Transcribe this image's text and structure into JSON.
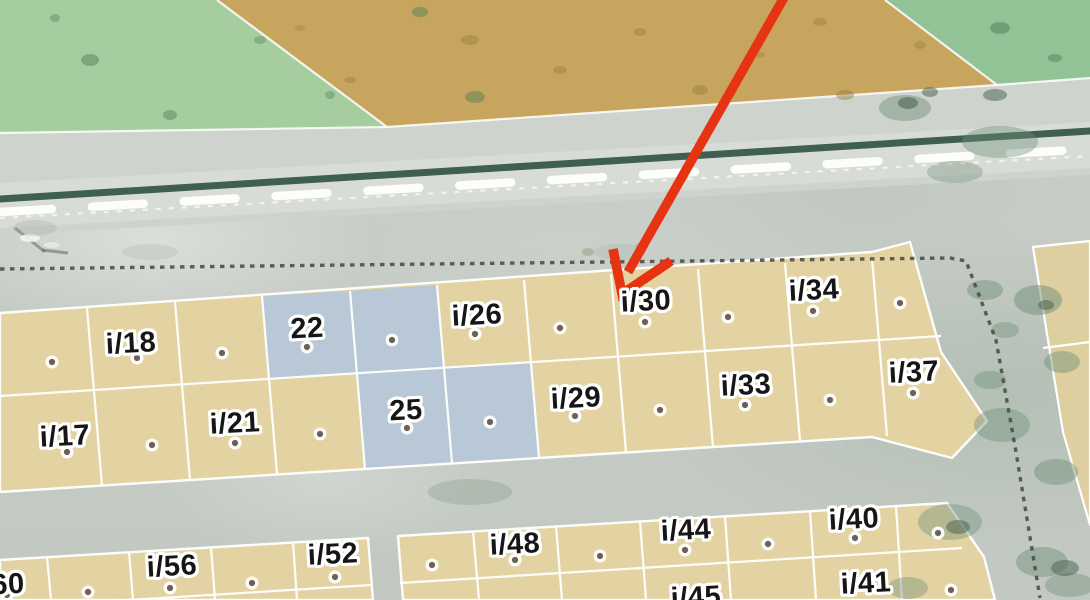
{
  "map": {
    "viewport": {
      "width": 1090,
      "height": 600
    },
    "colors": {
      "background": "#c6ccc6",
      "field_green_left": "#a5cd9f",
      "field_tan": "#c7a55e",
      "field_green_right": "#92c397",
      "road_band": "#ced3cd",
      "road_stripe": "#dde1da",
      "treeline": "#2f5244",
      "lane_dash": "#ffffff",
      "plot_fill": "#e4d3a2",
      "plot_blue": "#b8c8d6",
      "plot_line": "#ffffff",
      "boundary_dots": "#4b4b48",
      "arrow": "#e63312",
      "label_text": "#161616",
      "label_halo": "#ffffff",
      "marker_ring": "#ffffff",
      "marker_core": "#6a6258"
    },
    "fields": [
      {
        "name": "field-green-left",
        "points": "0,0 217,0 387,127 0,133",
        "fill": "#a5cd9f"
      },
      {
        "name": "field-tan",
        "points": "217,0 885,0 997,85 387,127",
        "fill": "#c7a55e"
      },
      {
        "name": "field-green-right",
        "points": "885,0 1090,0 1090,78 997,85",
        "fill": "#92c397"
      }
    ],
    "field_lines": [
      "217,0 387,127",
      "885,0 997,85",
      "0,133 387,127 997,85 1090,78"
    ],
    "road": {
      "band": "0,133 387,127 997,85 1090,78 1090,175 0,235",
      "stripe": "0,183 1090,122 1090,168 0,228",
      "treeline": [
        0,
        199,
        1090,
        131
      ],
      "dash_line": [
        0,
        212,
        1090,
        149
      ],
      "fence_line": [
        0,
        218,
        1090,
        156
      ],
      "track_lines": [
        [
          15,
          228,
          45,
          252
        ],
        [
          42,
          250,
          68,
          253
        ]
      ]
    },
    "east_block": {
      "outline": "1033,247 1090,241 1090,525 1063,432 1048,340",
      "row_lines": [
        [
          1043,
          348,
          1090,
          342
        ]
      ],
      "fill": "#ddcf9f"
    },
    "blocks": [
      {
        "name": "block-upper",
        "outline": "0,313 872,252 910,242 941,352 987,421 952,458 872,437 0,492",
        "col_lines": [
          [
            87,
            308,
            102,
            486
          ],
          [
            175,
            302,
            190,
            480
          ],
          [
            262,
            296,
            277,
            474
          ],
          [
            350,
            291,
            365,
            469
          ],
          [
            437,
            285,
            452,
            463
          ],
          [
            524,
            280,
            539,
            458
          ],
          [
            611,
            274,
            626,
            452
          ],
          [
            698,
            269,
            713,
            447
          ],
          [
            785,
            263,
            800,
            441
          ],
          [
            872,
            258,
            887,
            436
          ]
        ],
        "row_lines": [
          [
            0,
            396,
            941,
            336
          ]
        ],
        "blue_cells": [
          "262,296 350,291 357,373 269,379",
          "350,291 437,285 444,368 357,373",
          "357,373 444,368 452,463 365,469",
          "444,368 531,362 539,458 452,463"
        ]
      },
      {
        "name": "block-lower-left",
        "outline": "0,560 368,538 373,600 0,600",
        "col_lines": [
          [
            47,
            557,
            51,
            600
          ],
          [
            129,
            552,
            133,
            600
          ],
          [
            211,
            547,
            215,
            600
          ],
          [
            293,
            542,
            297,
            600
          ]
        ],
        "row_lines": [
          [
            0,
            608,
            371,
            585
          ]
        ],
        "blue_cells": []
      },
      {
        "name": "block-lower-right",
        "outline": "398,536 947,503 984,557 995,600 403,600",
        "col_lines": [
          [
            473,
            531,
            479,
            600
          ],
          [
            556,
            526,
            562,
            600
          ],
          [
            640,
            521,
            646,
            600
          ],
          [
            725,
            516,
            731,
            600
          ],
          [
            810,
            511,
            816,
            600
          ],
          [
            896,
            506,
            902,
            600
          ]
        ],
        "row_lines": [
          [
            400,
            583,
            962,
            548
          ]
        ],
        "blue_cells": []
      }
    ],
    "boundary": {
      "points": "0,269 950,258 966,261 996,340 1016,452 1040,598"
    },
    "plot_labels": [
      {
        "text": "i/18",
        "x": 131,
        "y": 344
      },
      {
        "text": "22",
        "x": 307,
        "y": 329
      },
      {
        "text": "i/26",
        "x": 477,
        "y": 316
      },
      {
        "text": "i/30",
        "x": 646,
        "y": 302
      },
      {
        "text": "i/34",
        "x": 814,
        "y": 291
      },
      {
        "text": "i/17",
        "x": 65,
        "y": 437
      },
      {
        "text": "i/21",
        "x": 235,
        "y": 424
      },
      {
        "text": "25",
        "x": 406,
        "y": 411
      },
      {
        "text": "i/29",
        "x": 576,
        "y": 399
      },
      {
        "text": "i/33",
        "x": 746,
        "y": 386
      },
      {
        "text": "i/37",
        "x": 914,
        "y": 373
      },
      {
        "text": "60",
        "x": 8,
        "y": 585
      },
      {
        "text": "i/56",
        "x": 172,
        "y": 567
      },
      {
        "text": "i/52",
        "x": 333,
        "y": 555
      },
      {
        "text": "i/48",
        "x": 515,
        "y": 545
      },
      {
        "text": "i/44",
        "x": 686,
        "y": 531
      },
      {
        "text": "i/40",
        "x": 854,
        "y": 520
      },
      {
        "text": "i/45",
        "x": 696,
        "y": 598
      },
      {
        "text": "i/41",
        "x": 866,
        "y": 584
      }
    ],
    "markers": [
      [
        52,
        362
      ],
      [
        137,
        358
      ],
      [
        222,
        353
      ],
      [
        307,
        347
      ],
      [
        392,
        340
      ],
      [
        475,
        334
      ],
      [
        560,
        328
      ],
      [
        645,
        322
      ],
      [
        728,
        317
      ],
      [
        813,
        311
      ],
      [
        900,
        303
      ],
      [
        67,
        452
      ],
      [
        152,
        445
      ],
      [
        235,
        443
      ],
      [
        320,
        434
      ],
      [
        407,
        428
      ],
      [
        490,
        422
      ],
      [
        575,
        416
      ],
      [
        660,
        410
      ],
      [
        745,
        405
      ],
      [
        830,
        400
      ],
      [
        913,
        393
      ],
      [
        7,
        595
      ],
      [
        88,
        592
      ],
      [
        170,
        588
      ],
      [
        252,
        583
      ],
      [
        335,
        577
      ],
      [
        432,
        565
      ],
      [
        515,
        560
      ],
      [
        600,
        556
      ],
      [
        685,
        550
      ],
      [
        768,
        544
      ],
      [
        855,
        538
      ],
      [
        938,
        533
      ],
      [
        951,
        590
      ]
    ],
    "scrub_blobs": [
      [
        905,
        108,
        26,
        13,
        "#6f8f77",
        0.45
      ],
      [
        1000,
        142,
        38,
        16,
        "#6f8f77",
        0.4
      ],
      [
        955,
        172,
        28,
        11,
        "#6f8f77",
        0.35
      ],
      [
        930,
        92,
        8,
        5,
        "#46604f",
        0.5
      ],
      [
        908,
        103,
        10,
        6,
        "#46604f",
        0.55
      ],
      [
        995,
        95,
        12,
        6,
        "#46604f",
        0.5
      ],
      [
        985,
        290,
        18,
        10,
        "#6f8f77",
        0.45
      ],
      [
        1005,
        330,
        14,
        8,
        "#6f8f77",
        0.4
      ],
      [
        990,
        380,
        16,
        9,
        "#6f8f77",
        0.4
      ],
      [
        1038,
        300,
        24,
        15,
        "#6f8f77",
        0.5
      ],
      [
        1062,
        362,
        18,
        11,
        "#6f8f77",
        0.45
      ],
      [
        1002,
        425,
        28,
        17,
        "#6f8f77",
        0.4
      ],
      [
        1056,
        472,
        22,
        13,
        "#6f8f77",
        0.45
      ],
      [
        950,
        522,
        32,
        18,
        "#6f8f77",
        0.4
      ],
      [
        1042,
        562,
        26,
        15,
        "#6f8f77",
        0.45
      ],
      [
        908,
        588,
        20,
        11,
        "#6f8f77",
        0.4
      ],
      [
        1070,
        585,
        25,
        12,
        "#6f8f77",
        0.4
      ],
      [
        1046,
        305,
        8,
        5,
        "#46604f",
        0.5
      ],
      [
        958,
        527,
        12,
        7,
        "#46604f",
        0.5
      ],
      [
        1065,
        568,
        14,
        8,
        "#46604f",
        0.5
      ],
      [
        470,
        492,
        42,
        13,
        "#8fa391",
        0.4
      ],
      [
        150,
        252,
        28,
        8,
        "#aab6aa",
        0.3
      ],
      [
        620,
        252,
        26,
        8,
        "#9fae9f",
        0.25
      ],
      [
        35,
        228,
        22,
        8,
        "#9fae9f",
        0.3
      ]
    ],
    "speckles": [
      [
        470,
        40,
        9,
        5,
        "#9b7f42",
        0.5
      ],
      [
        560,
        70,
        7,
        4,
        "#9b7f42",
        0.45
      ],
      [
        640,
        32,
        6,
        4,
        "#9b7f42",
        0.45
      ],
      [
        700,
        90,
        8,
        5,
        "#9b7f42",
        0.5
      ],
      [
        760,
        55,
        5,
        3,
        "#9b7f42",
        0.4
      ],
      [
        820,
        22,
        7,
        4,
        "#9b7f42",
        0.45
      ],
      [
        845,
        95,
        9,
        5,
        "#9b7f42",
        0.5
      ],
      [
        920,
        45,
        6,
        4,
        "#9b7f42",
        0.4
      ],
      [
        350,
        80,
        6,
        3,
        "#9b7f42",
        0.45
      ],
      [
        300,
        28,
        5,
        3,
        "#9b7f42",
        0.4
      ],
      [
        90,
        60,
        9,
        6,
        "#567f57",
        0.5
      ],
      [
        170,
        115,
        7,
        5,
        "#567f57",
        0.45
      ],
      [
        260,
        40,
        6,
        4,
        "#567f57",
        0.4
      ],
      [
        420,
        12,
        8,
        5,
        "#567f57",
        0.5
      ],
      [
        330,
        95,
        5,
        4,
        "#567f57",
        0.4
      ],
      [
        475,
        97,
        10,
        6,
        "#567f57",
        0.5
      ],
      [
        55,
        18,
        5,
        4,
        "#567f57",
        0.4
      ],
      [
        1000,
        28,
        10,
        6,
        "#4e7a55",
        0.5
      ],
      [
        1055,
        58,
        7,
        4,
        "#4e7a55",
        0.45
      ],
      [
        30,
        238,
        10,
        4,
        "#f2f4f0",
        0.9
      ],
      [
        52,
        245,
        8,
        3,
        "#e8ebe6",
        0.8
      ],
      [
        588,
        252,
        6,
        4,
        "#8a8a6a",
        0.4
      ],
      [
        640,
        246,
        5,
        3,
        "#8a8a6a",
        0.3
      ],
      [
        740,
        300,
        5,
        3,
        "#8a8a6a",
        0.35
      ]
    ],
    "arrow": {
      "target": "i/30",
      "shaft": [
        786,
        -6,
        628,
        272
      ],
      "head": "613,249 622,294 671,261",
      "width": 9.5
    }
  }
}
